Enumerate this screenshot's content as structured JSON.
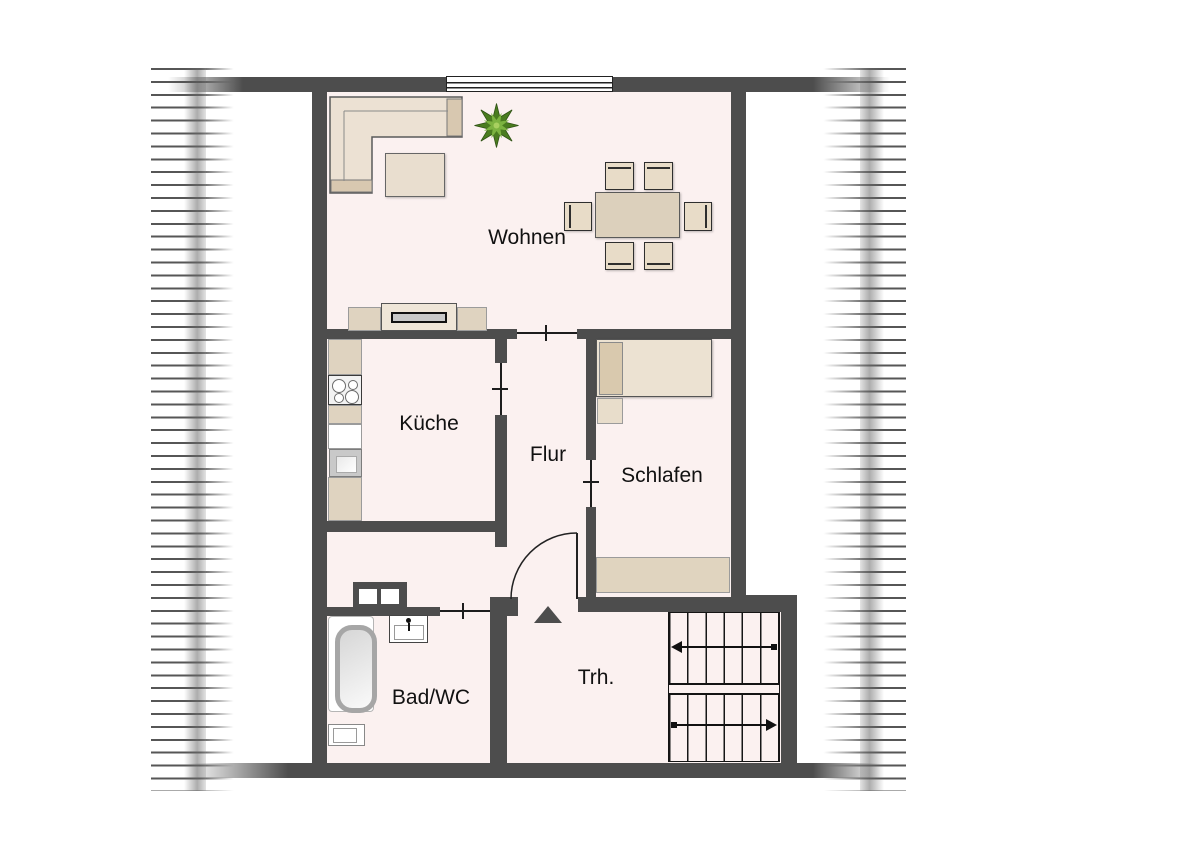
{
  "rooms": {
    "wohnen": "Wohnen",
    "kueche": "Küche",
    "flur": "Flur",
    "schlafen": "Schlafen",
    "badwc": "Bad/WC",
    "trh": "Trh."
  },
  "colors": {
    "wall": "#4d4d4d",
    "floor": "#fbf1f0",
    "furniture_light": "#ece1d3",
    "furniture_accent": "#d8c8b0",
    "plant_green": "#7cb340",
    "stair_line": "#141414"
  },
  "stairs": {
    "flights": 2,
    "treads_per_flight": 6,
    "upper_arrow_direction": "left",
    "lower_arrow_direction": "right"
  },
  "window_count": 1,
  "plan_type": "floorplan-attic-apartment"
}
